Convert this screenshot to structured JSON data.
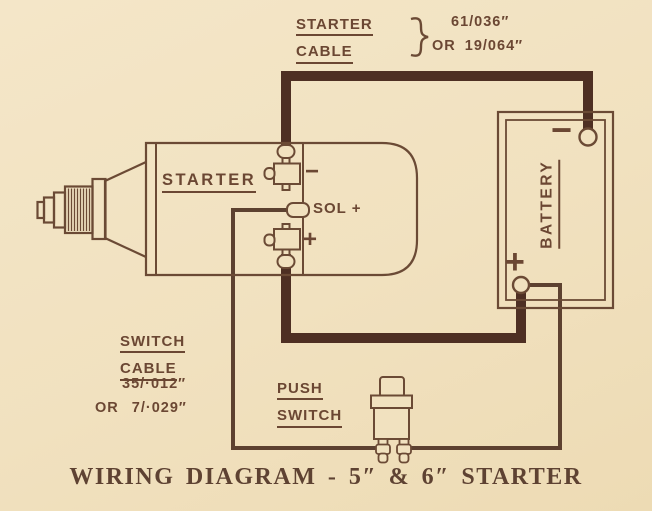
{
  "colors": {
    "paper": "#f1e1bf",
    "ink": "#6b4a35",
    "wire_heavy": "#4e2f23",
    "wire_light": "#5d4130",
    "title_ink": "#5e4232"
  },
  "annotations": {
    "starter_cable": {
      "line1": "STARTER",
      "line2": "CABLE",
      "size_primary": "61/036″",
      "size_alt": "OR 19/064″"
    },
    "switch_cable": {
      "line1": "SWITCH",
      "line2": "CABLE",
      "size_primary": "35/·012″",
      "size_alt": "OR 7/·029″"
    }
  },
  "starter": {
    "label": "STARTER",
    "terminal_minus": "−",
    "terminal_sol": "SOL +",
    "terminal_plus": "+"
  },
  "battery": {
    "label": "BATTERY",
    "terminal_minus": "−",
    "terminal_plus": "+"
  },
  "push_switch": {
    "line1": "PUSH",
    "line2": "SWITCH"
  },
  "title": "WIRING DIAGRAM - 5″ & 6″ STARTER"
}
